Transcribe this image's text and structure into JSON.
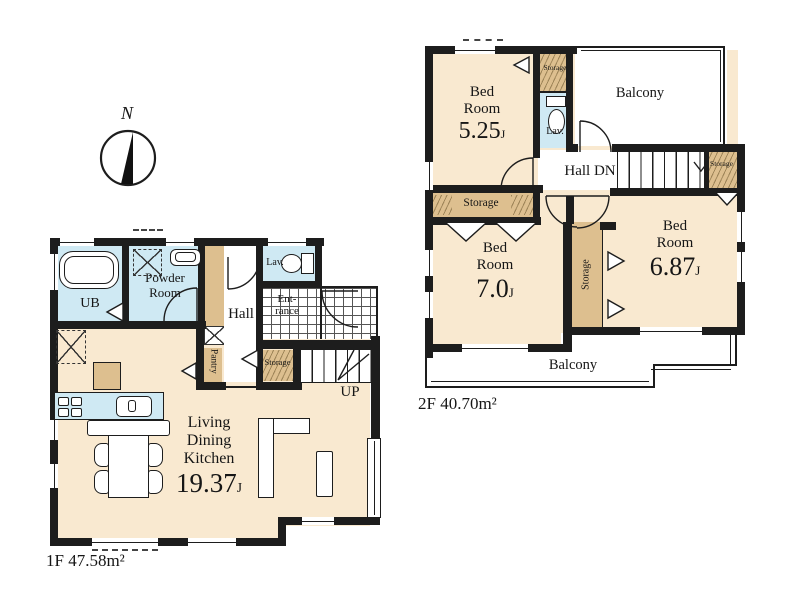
{
  "colors": {
    "wall": "#1d1d1d",
    "floor": "#f9e9d0",
    "wet": "#cfe9f3",
    "storage": "#ddbf8f"
  },
  "compass": {
    "north_label": "N"
  },
  "floor1": {
    "area_label": "1F 47.58m²",
    "rooms": {
      "ub": {
        "label": "UB"
      },
      "powder": {
        "line1": "Powder",
        "line2": "Room"
      },
      "hall": {
        "label": "Hall"
      },
      "lav": {
        "label": "Lav."
      },
      "entrance": {
        "line1": "Ent-",
        "line2": "rance"
      },
      "pantry": {
        "label": "Pantry"
      },
      "storage": {
        "label": "Storage"
      },
      "stairs": {
        "label": "UP"
      },
      "ldk": {
        "line1": "Living",
        "line2": "Dining",
        "line3": "Kitchen",
        "size": "19.37",
        "unit": "J"
      }
    }
  },
  "floor2": {
    "area_label": "2F 40.70m²",
    "rooms": {
      "bed1": {
        "line1": "Bed",
        "line2": "Room",
        "size": "5.25",
        "unit": "J"
      },
      "bed2": {
        "line1": "Bed",
        "line2": "Room",
        "size": "7.0",
        "unit": "J"
      },
      "bed3": {
        "line1": "Bed",
        "line2": "Room",
        "size": "6.87",
        "unit": "J"
      },
      "lav": {
        "label": "Lav."
      },
      "hall": {
        "label": "Hall DN"
      },
      "balcony_top": {
        "label": "Balcony"
      },
      "balcony_bottom": {
        "label": "Balcony"
      },
      "storage_top": {
        "label": "Storage"
      },
      "storage_right": {
        "label": "Storage"
      },
      "storage_strip": {
        "label": "Storage"
      },
      "storage_center": {
        "label": "Storage"
      }
    }
  }
}
